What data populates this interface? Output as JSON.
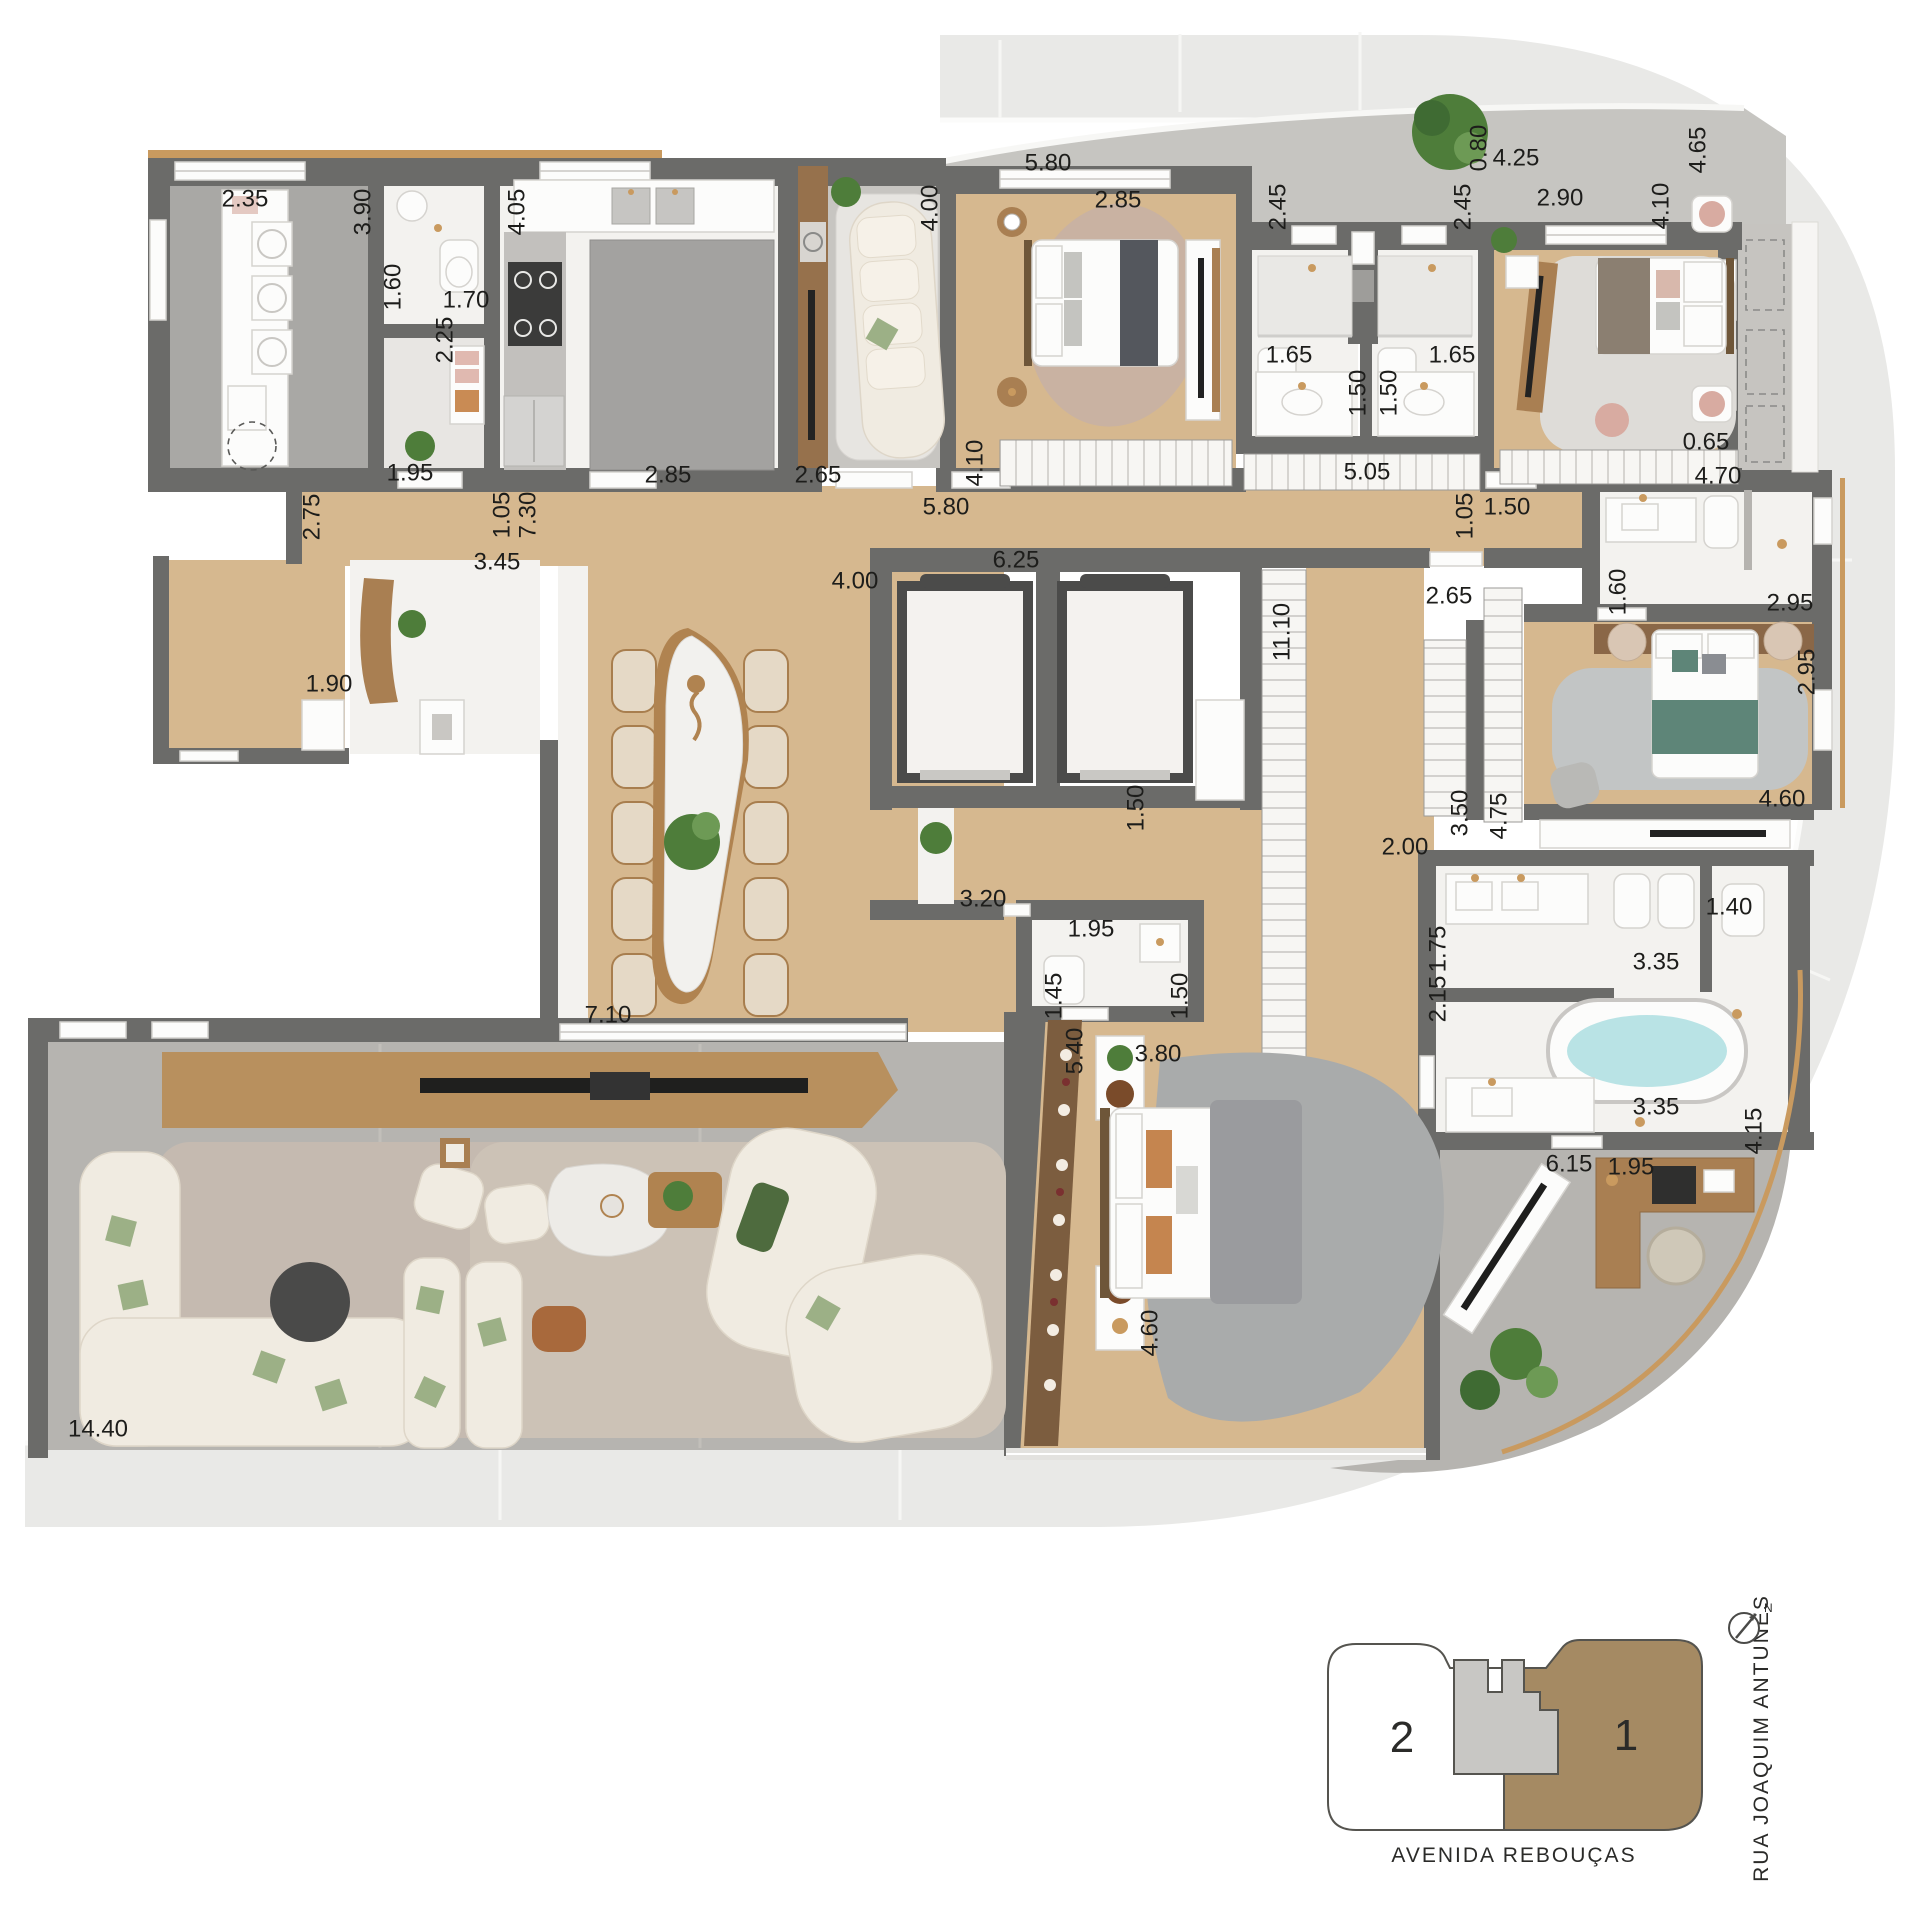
{
  "plan": {
    "type": "apartment-floor-plan",
    "units_scale": "meters",
    "colors": {
      "walls": "#6b6b69",
      "wood_floor": "#d6b88f",
      "marble_floor": "#f3f2ef",
      "terrace_floor": "#b6b4b0",
      "sidewalk": "#e9e9e7",
      "gold_trim": "#c99a5f",
      "keyplan_unit1": "#a58a63",
      "keyplan_core": "#c8c7c4",
      "green_bed": "#5e8578",
      "bath_water": "#b9e3e5"
    },
    "dimensions": [
      {
        "text": "2.35",
        "x": 245,
        "y": 198,
        "o": 0
      },
      {
        "text": "3.90",
        "x": 362,
        "y": 212,
        "o": 1
      },
      {
        "text": "4.05",
        "x": 516,
        "y": 212,
        "o": 1
      },
      {
        "text": "1.60",
        "x": 392,
        "y": 287,
        "o": 1
      },
      {
        "text": "1.70",
        "x": 466,
        "y": 299,
        "o": 0
      },
      {
        "text": "2.25",
        "x": 444,
        "y": 340,
        "o": 1
      },
      {
        "text": "1.95",
        "x": 410,
        "y": 472,
        "o": 0
      },
      {
        "text": "2.85",
        "x": 668,
        "y": 474,
        "o": 0
      },
      {
        "text": "2.75",
        "x": 311,
        "y": 517,
        "o": 1
      },
      {
        "text": "1.05",
        "x": 501,
        "y": 515,
        "o": 1
      },
      {
        "text": "7.30",
        "x": 527,
        "y": 515,
        "o": 1
      },
      {
        "text": "3.45",
        "x": 497,
        "y": 561,
        "o": 0
      },
      {
        "text": "1.90",
        "x": 329,
        "y": 683,
        "o": 0
      },
      {
        "text": "4.00",
        "x": 855,
        "y": 580,
        "o": 0
      },
      {
        "text": "5.80",
        "x": 1048,
        "y": 162,
        "o": 0
      },
      {
        "text": "4.00",
        "x": 929,
        "y": 208,
        "o": 1
      },
      {
        "text": "2.85",
        "x": 1118,
        "y": 199,
        "o": 0
      },
      {
        "text": "2.65",
        "x": 818,
        "y": 474,
        "o": 0
      },
      {
        "text": "4.10",
        "x": 974,
        "y": 463,
        "o": 1
      },
      {
        "text": "5.80",
        "x": 946,
        "y": 506,
        "o": 0
      },
      {
        "text": "6.25",
        "x": 1016,
        "y": 559,
        "o": 0
      },
      {
        "text": "0.80",
        "x": 1478,
        "y": 148,
        "o": 1
      },
      {
        "text": "4.25",
        "x": 1516,
        "y": 157,
        "o": 0
      },
      {
        "text": "2.45",
        "x": 1277,
        "y": 207,
        "o": 1
      },
      {
        "text": "2.45",
        "x": 1462,
        "y": 207,
        "o": 1
      },
      {
        "text": "2.90",
        "x": 1560,
        "y": 197,
        "o": 0
      },
      {
        "text": "4.10",
        "x": 1660,
        "y": 206,
        "o": 1
      },
      {
        "text": "4.65",
        "x": 1697,
        "y": 150,
        "o": 1
      },
      {
        "text": "1.65",
        "x": 1289,
        "y": 354,
        "o": 0
      },
      {
        "text": "1.65",
        "x": 1452,
        "y": 354,
        "o": 0
      },
      {
        "text": "1.50",
        "x": 1357,
        "y": 393,
        "o": 1
      },
      {
        "text": "1.50",
        "x": 1388,
        "y": 393,
        "o": 1
      },
      {
        "text": "5.05",
        "x": 1367,
        "y": 471,
        "o": 0
      },
      {
        "text": "4.70",
        "x": 1718,
        "y": 475,
        "o": 0
      },
      {
        "text": "0.65",
        "x": 1706,
        "y": 441,
        "o": 0
      },
      {
        "text": "1.05",
        "x": 1464,
        "y": 516,
        "o": 1
      },
      {
        "text": "1.50",
        "x": 1507,
        "y": 506,
        "o": 0
      },
      {
        "text": "1.60",
        "x": 1617,
        "y": 592,
        "o": 1
      },
      {
        "text": "2.95",
        "x": 1790,
        "y": 602,
        "o": 0
      },
      {
        "text": "11.10",
        "x": 1281,
        "y": 632,
        "o": 1
      },
      {
        "text": "2.65",
        "x": 1449,
        "y": 595,
        "o": 0
      },
      {
        "text": "2.95",
        "x": 1806,
        "y": 672,
        "o": 1
      },
      {
        "text": "4.60",
        "x": 1782,
        "y": 798,
        "o": 0
      },
      {
        "text": "3.50",
        "x": 1459,
        "y": 813,
        "o": 1
      },
      {
        "text": "4.75",
        "x": 1498,
        "y": 816,
        "o": 1
      },
      {
        "text": "2.00",
        "x": 1405,
        "y": 846,
        "o": 0
      },
      {
        "text": "1.50",
        "x": 1135,
        "y": 808,
        "o": 1
      },
      {
        "text": "3.20",
        "x": 983,
        "y": 898,
        "o": 0
      },
      {
        "text": "1.95",
        "x": 1091,
        "y": 928,
        "o": 0
      },
      {
        "text": "1.45",
        "x": 1053,
        "y": 996,
        "o": 1
      },
      {
        "text": "1.50",
        "x": 1179,
        "y": 996,
        "o": 1
      },
      {
        "text": "5.40",
        "x": 1074,
        "y": 1051,
        "o": 1
      },
      {
        "text": "3.80",
        "x": 1158,
        "y": 1053,
        "o": 0
      },
      {
        "text": "4.60",
        "x": 1149,
        "y": 1333,
        "o": 1
      },
      {
        "text": "1.75",
        "x": 1437,
        "y": 949,
        "o": 1
      },
      {
        "text": "2.15",
        "x": 1437,
        "y": 999,
        "o": 1
      },
      {
        "text": "1.40",
        "x": 1729,
        "y": 906,
        "o": 0
      },
      {
        "text": "3.35",
        "x": 1656,
        "y": 961,
        "o": 0
      },
      {
        "text": "3.35",
        "x": 1656,
        "y": 1106,
        "o": 0
      },
      {
        "text": "4.15",
        "x": 1753,
        "y": 1131,
        "o": 1
      },
      {
        "text": "6.15",
        "x": 1569,
        "y": 1163,
        "o": 0
      },
      {
        "text": "1.95",
        "x": 1631,
        "y": 1166,
        "o": 0
      },
      {
        "text": "7.10",
        "x": 608,
        "y": 1014,
        "o": 0
      },
      {
        "text": "14.40",
        "x": 98,
        "y": 1428,
        "o": 0
      }
    ],
    "key_plan": {
      "unit_left": "2",
      "unit_right": "1",
      "street_bottom": "AVENIDA REBOUÇAS",
      "street_right": "RUA JOAQUIM ANTUNES",
      "north": "N"
    }
  }
}
